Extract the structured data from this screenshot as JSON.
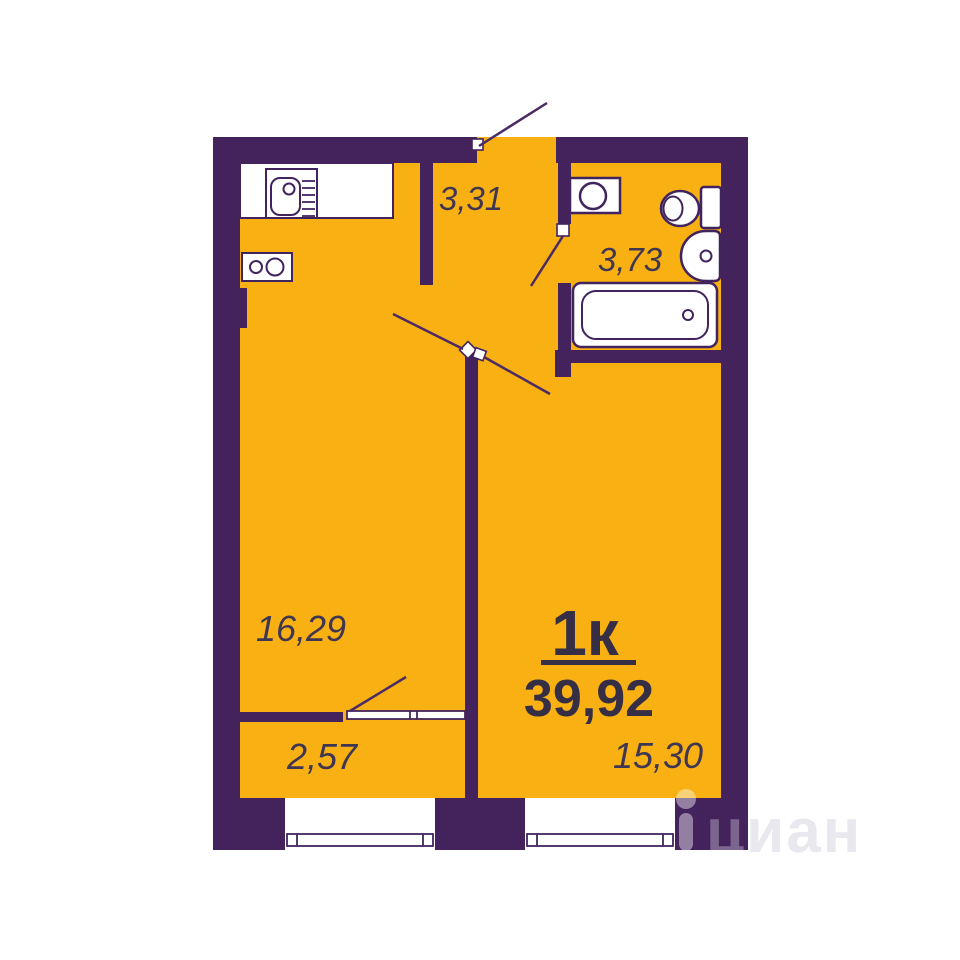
{
  "plan": {
    "type_label": "1к",
    "total_area": "39,92",
    "areas": {
      "hallway": "3,31",
      "bathroom": "3,73",
      "living": "16,29",
      "balcony": "2,57",
      "room": "15,30"
    },
    "fixtures": [
      "kitchen-sink",
      "stove",
      "washing-machine",
      "toilet",
      "bathroom-sink",
      "bathtub"
    ],
    "colors": {
      "wall": "#44235d",
      "floor": "#f8b013",
      "fixture_outline": "#41245e",
      "door_line": "#4b2b63",
      "label_text": "#3f3651",
      "title_text": "#352e44"
    }
  },
  "watermark": {
    "letter_on_wall": "ц",
    "letters_rest": "иан",
    "icon": "map-pin-icon"
  }
}
